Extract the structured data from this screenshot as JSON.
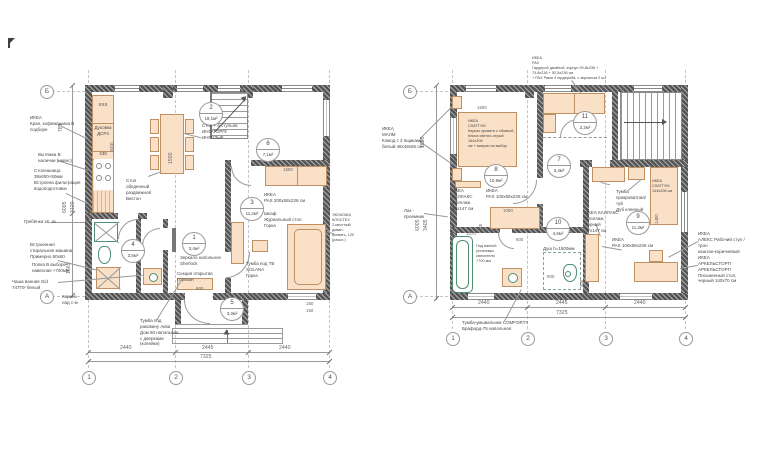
{
  "f1": {
    "axes": {
      "c1": "1",
      "c2": "2",
      "c3": "3",
      "c4": "4",
      "rA": "А",
      "rB": "Б"
    },
    "rooms": [
      {
        "num": "1",
        "area": "3,4м²"
      },
      {
        "num": "2",
        "area": "18,1м²"
      },
      {
        "num": "3",
        "area": "11,2м²"
      },
      {
        "num": "4",
        "area": "3,5м²"
      },
      {
        "num": "5",
        "area": "3,3м²"
      },
      {
        "num": "6",
        "area": "7,1м²"
      }
    ],
    "kitchen": {
      "k1": "ХХХ",
      "k2": "Духовка\nДСР4",
      "k3": "430"
    },
    "dims": {
      "b1": "2440",
      "b2": "2445",
      "b3": "2440",
      "total": "7325",
      "door": "900",
      "s1": "150",
      "s2": "150",
      "v1": "785",
      "v2": "6005",
      "v3": "3120",
      "v4": "1565",
      "table": "1500",
      "pax": "1600",
      "kit": "600"
    },
    "ann": {
      "faucet": "ИКЕА\nКран, кофемашина В\nподборе",
      "hood": "Вытяжка В\nналичии (навес)",
      "counter": "Столешница\n38х600+50мм\nВстроена фильтрация\nводоподготовки",
      "comb": "Гребёнка хв, гв",
      "washer": "Встроенная\nстиральная машина\nПримерно 60х60",
      "shelf": "Полка В выборе\nнавесная +700мм",
      "bowl": "Чаша ванная Gid\n747ПУ белый",
      "cornice": "Карниз\nнад с-м",
      "dining_set": "Стол + 6 стульев\nИНГАТОРП/ИНГОЛЬФ",
      "dining_table": "Стол обеденный\nраздвижной\nВистон",
      "mirror": "Зеркало напольное\nSherlock",
      "section": "Секция открытая\nГоризон",
      "pax": "ИКЕА\nPAX 200х58х236 см",
      "side_table": "Шкаф\nЖурнальный стол\nГорка",
      "tv": "Тумба под ТВ SOLANA\nГорка",
      "sofa": "ЭКОКОЖА\nКОНСТЕХ\n2-местный\nдиван-\nкровать, 120\n(раскл.)",
      "vanity": "Тумба под\nраковину Аква\nДом 60 напольная\nс дверками (копейки)"
    }
  },
  "f2": {
    "axes": {
      "c1": "1",
      "c2": "2",
      "c3": "3",
      "c4": "4",
      "rA": "А",
      "rB": "Б"
    },
    "rooms": [
      {
        "num": "7",
        "area": "3,4м²"
      },
      {
        "num": "8",
        "area": "10,9м²"
      },
      {
        "num": "9",
        "area": "11,3м²"
      },
      {
        "num": "10",
        "area": "4,6м²"
      },
      {
        "num": "11",
        "area": "2,2м²"
      }
    ],
    "dims": {
      "b1": "2440",
      "b2": "2445",
      "b3": "2440",
      "total": "7325",
      "v1": "1805",
      "v2": "6005",
      "v3": "3405",
      "bed8": "1600",
      "bed9": "1400",
      "pax": "1000",
      "pax_d": "420",
      "bath": "1370",
      "shower_w": "600",
      "shower_d": "900",
      "kallax": "400"
    },
    "ann": {
      "pax_top": "ИКЕА\nPAX\nГардероб двойной, корпус 99,8х236 +\n74,8х236 + 52,5х236 см\n+ PAX Рама 4 гардероба, с зеркалом 2 шт",
      "malm": "ИКЕА\nМАЛМ\nКомод с 3 ящиками,\nбелый 48х48х55 см",
      "hatch": "Лаз -\nпроемник",
      "kallax1": "ИКЕА КАЛЛАКС\nСтеллаж\n42х147 см",
      "pax100a": "ИКЕА\nPAX 100х58х236 см",
      "bed8": "ИКЕА\nСЛАТТУМ\nКаркас кровати с обивкой,\nКниса светло-серый 164х206\nсм + матрас на выбор",
      "tumba9": "Тумба\nприкроватная/туй\nДуб клееный",
      "bed9": "ИКЕА\nСЛАТТУМ\n144х206 см",
      "kallax2": "ИКЕА КАЛЛАКС\nСтеллаж, черный\n77х147 см",
      "pax100b": "ИКЕА\nPAX 100х58х236 см",
      "alex": "ИКЕА\nАЛЕКС Рабочий стул /трон\nкаштан-коричневый",
      "arkel": "ИКЕА\nАРКЕЛЬСТОРП АРКЕЛЬСТОРП\nПисьменный стол,\nчерный 140х70 см",
      "comforty": "Тумба-умывальник COMFORTY\nБрафорд-75 напольная",
      "shower": "Душ h=1500мм",
      "tub": "Под ванной\nустановка\nсмесителя\n+700 мм"
    }
  }
}
